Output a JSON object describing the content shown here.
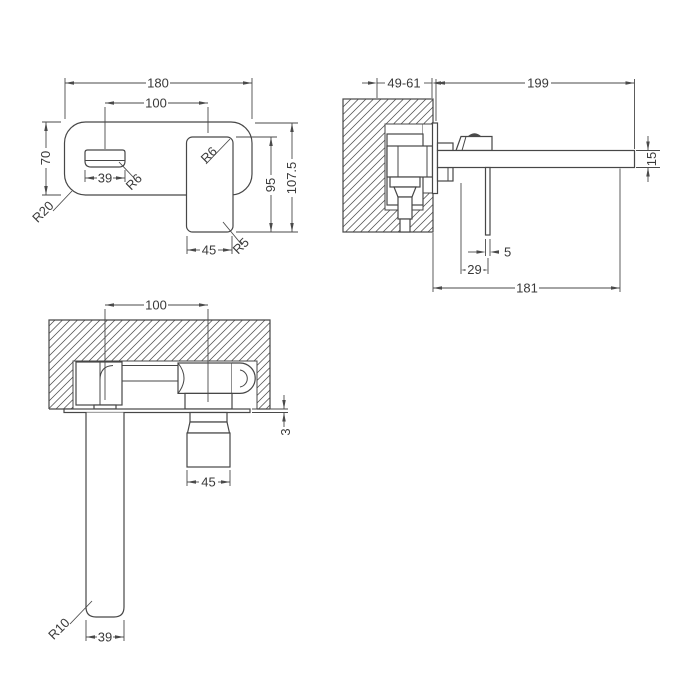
{
  "drawing": {
    "description": "wall-mounted basin mixer tap dimension drawing, three orthographic views",
    "colors": {
      "line": "#474747",
      "text": "#3a3a3a",
      "background": "#ffffff"
    },
    "dims": {
      "front": {
        "width": "180",
        "centers": "100",
        "plate_height": "70",
        "spout_width": "39",
        "spout_radius": "R6",
        "plate_radius": "R20",
        "handle_radius": "R6",
        "handle_height": "95",
        "total_height": "107.5",
        "handle_width": "45",
        "handle_bottom_radius": "R5"
      },
      "side": {
        "wall_depth": "49-61",
        "spout_length": "199",
        "spout_thickness": "15",
        "lever_thickness": "5",
        "lever_offset": "29",
        "spout_reach": "181"
      },
      "plan": {
        "centers": "100",
        "plate_thickness": "3",
        "handle_width": "45",
        "spout_end_radius": "R10",
        "spout_width": "39"
      }
    }
  }
}
